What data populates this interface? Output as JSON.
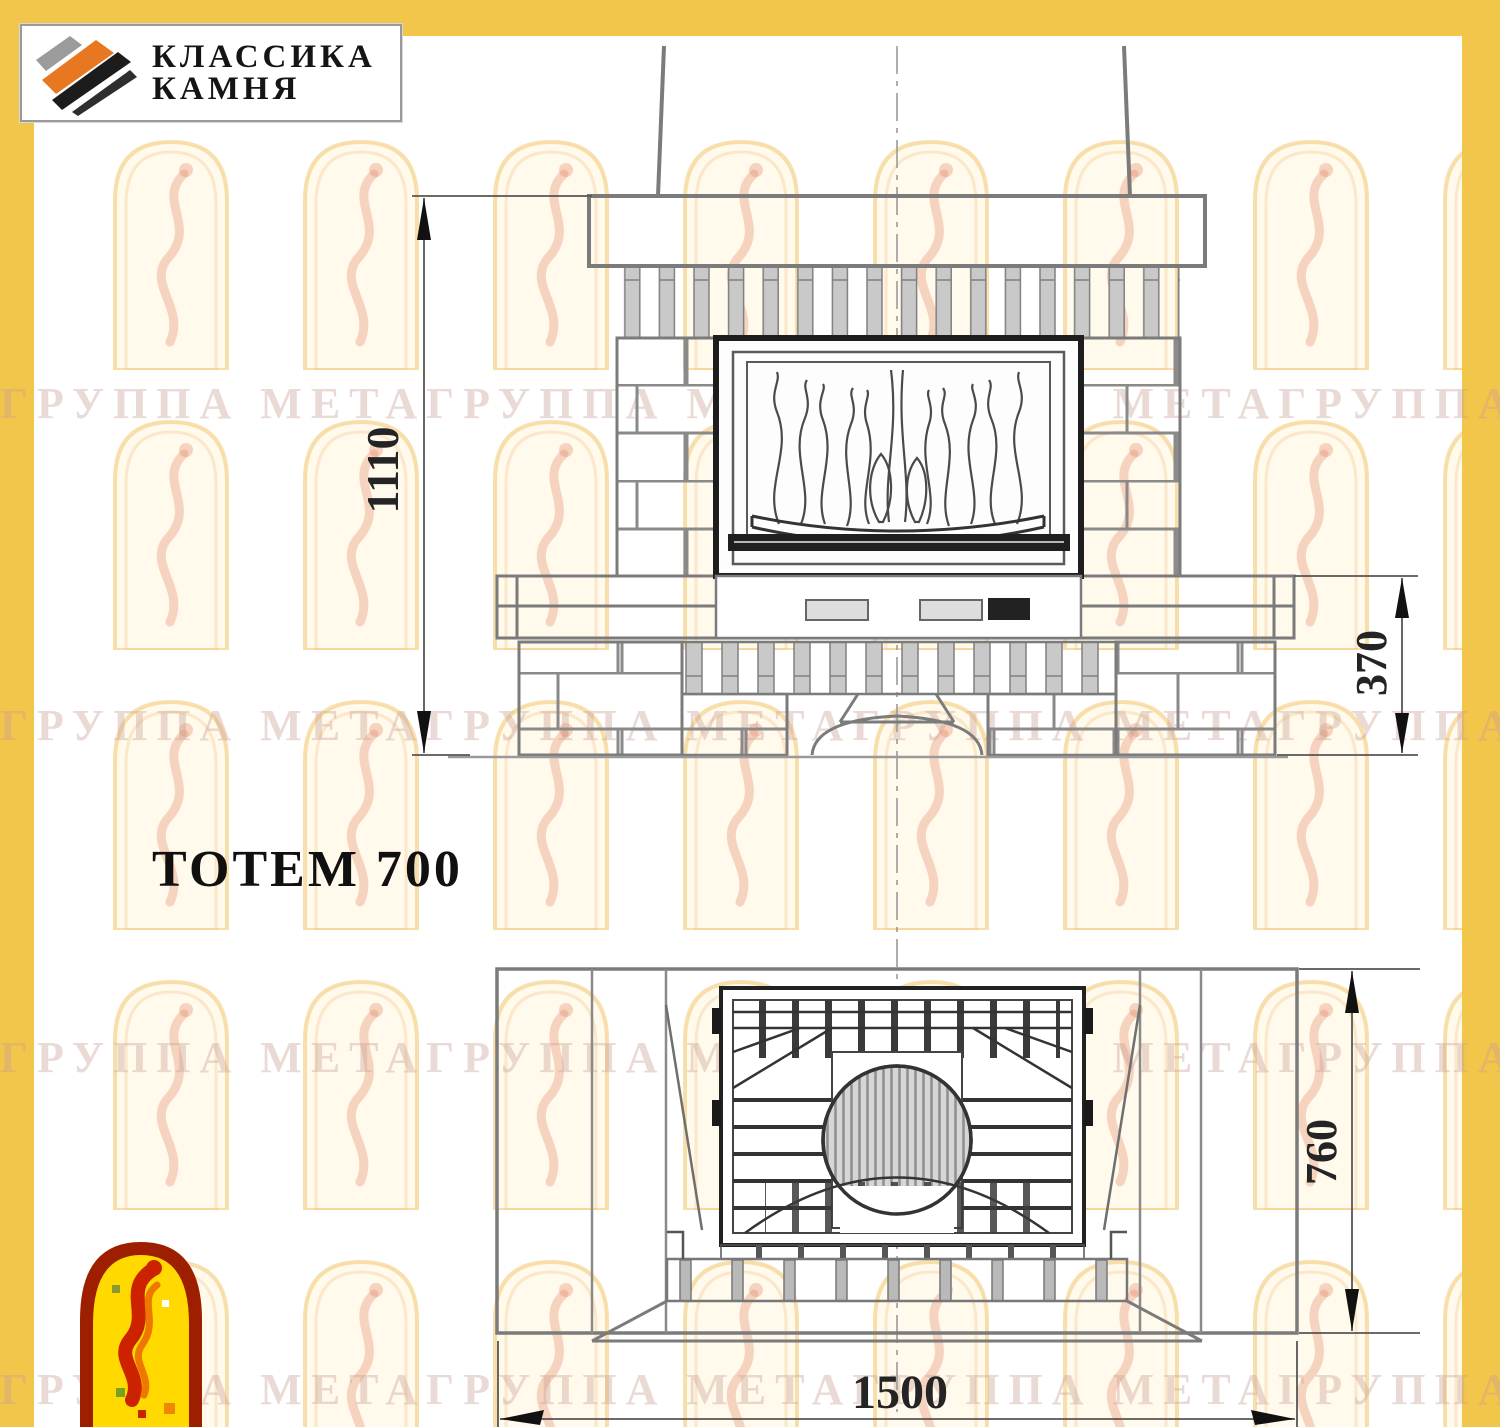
{
  "page": {
    "frame_color": "#F2C64B",
    "background": "#FFFFFF"
  },
  "logo": {
    "line1": "КЛАССИКА",
    "line2": "КАМНЯ",
    "stripe_gray": "#9B9B9B",
    "stripe_orange": "#E87722",
    "stripe_black": "#1C1C1C"
  },
  "drawing": {
    "title": "ТОТЕМ 700",
    "views": {
      "front_view_dims": {
        "overall_height": "1110",
        "base_height": "370"
      },
      "plan_view_dims": {
        "depth": "760",
        "width": "1500"
      }
    }
  },
  "watermark": {
    "row_text": "ГРУППА МЕТАГРУППА МЕТАГРУППА МЕТАГРУППА МЕТАГРУППА МЕТАГРУППА МЕТА",
    "text_color": "rgba(201,158,147,0.38)",
    "arch_stroke": "#F3C46E",
    "arch_fill": "#FFF7DE",
    "figure_color": "#E07A5A"
  },
  "emblem": {
    "border_color": "#9E1E00",
    "fill_color": "#FFD900",
    "figure_red": "#CC2200",
    "figure_orange": "#EE7700"
  }
}
